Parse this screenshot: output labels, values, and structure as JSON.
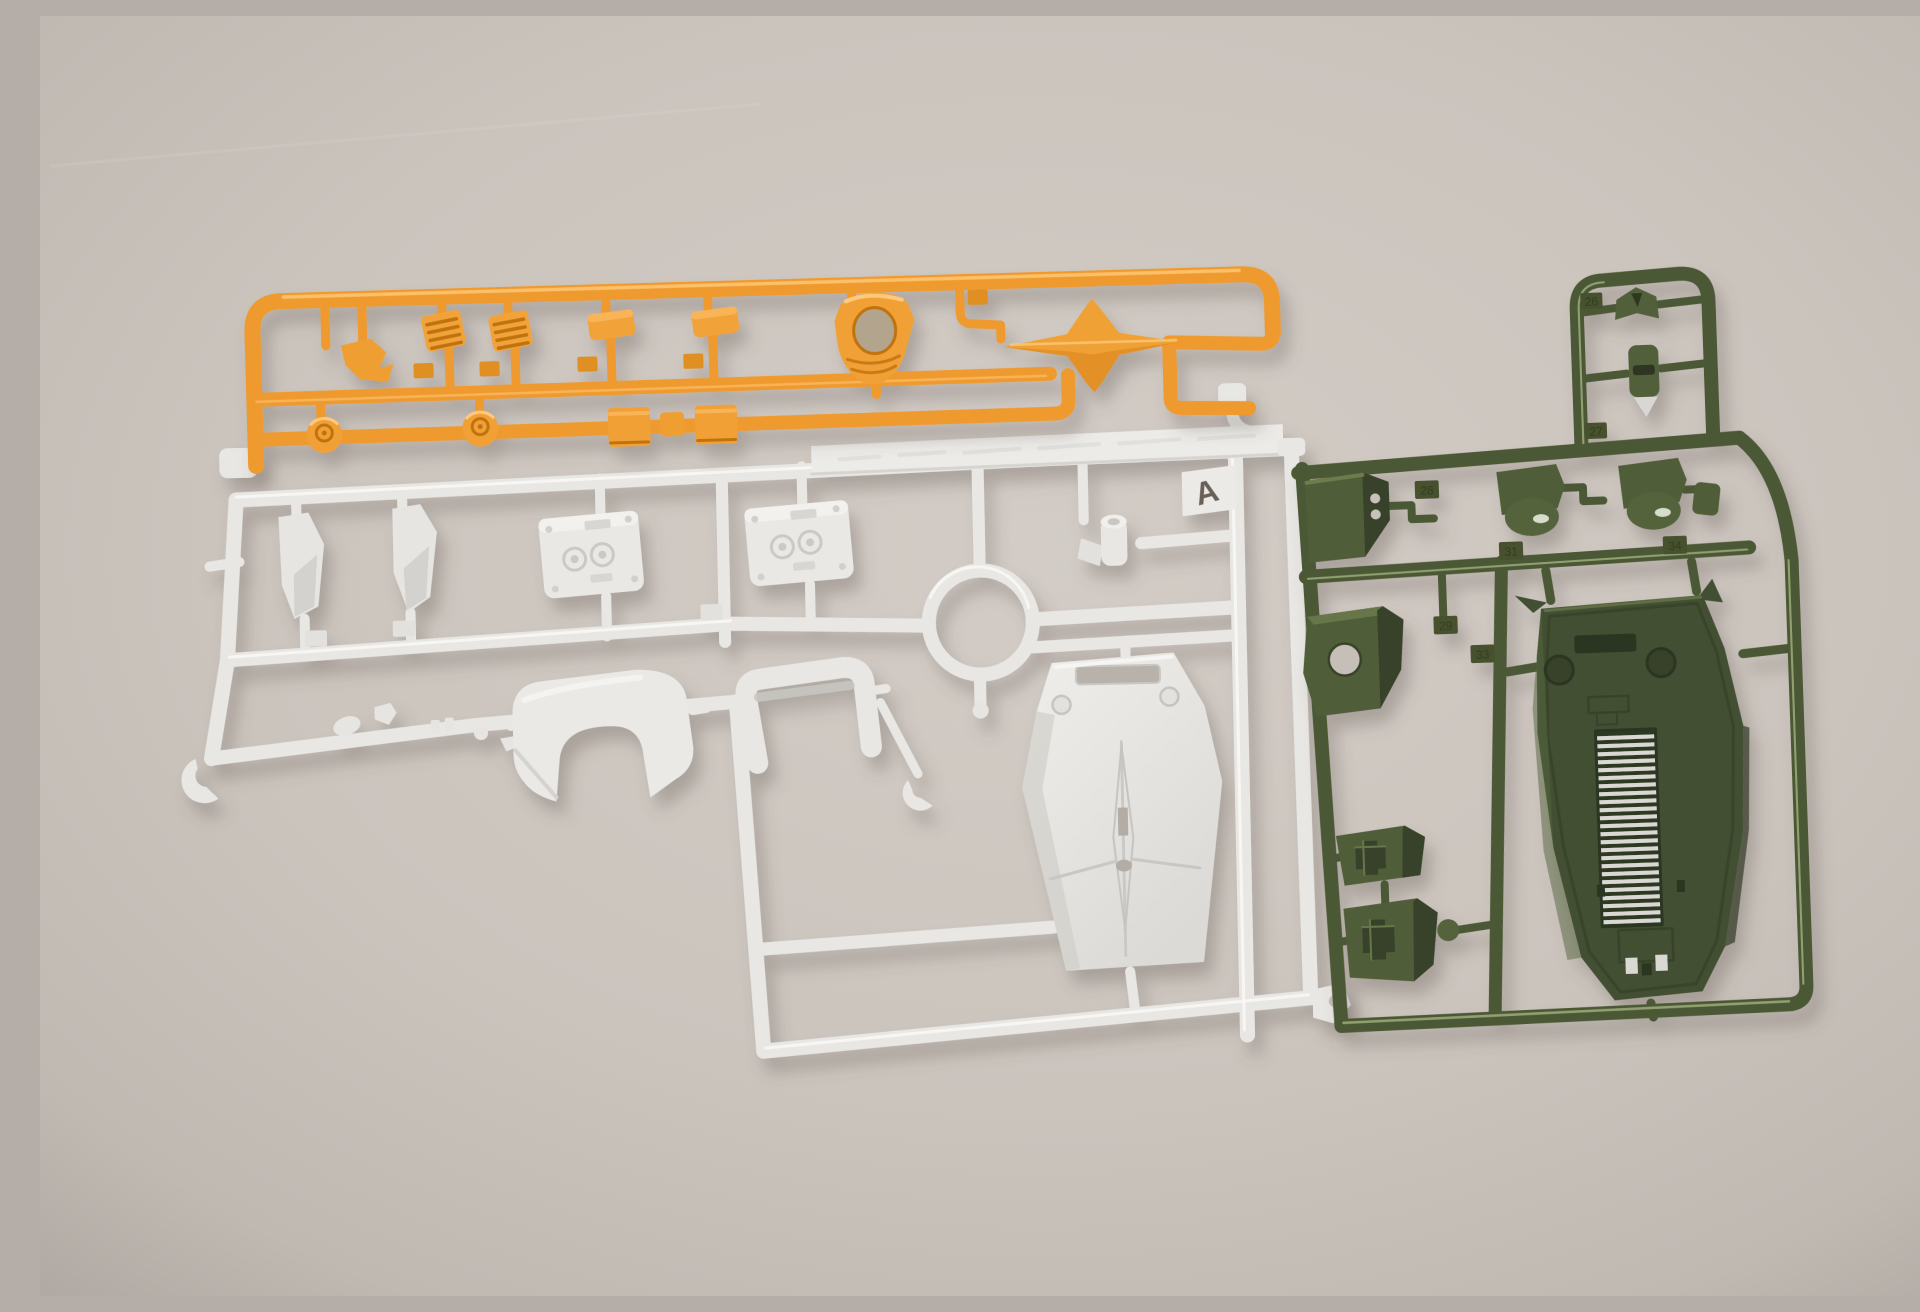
{
  "scene": {
    "type": "photograph",
    "description": "Top-down photo of three injection-molded plastic model-kit runners (sprues) lying on a plain warm-gray surface: a small orange parts runner at top left, a large light-gray runner marked A in the center, and an olive-green runner on the right.",
    "background_color": "#cbc5bf"
  },
  "orange_sprue": {
    "name": "orange parts runner",
    "color": "#ee9a2e",
    "position": "top-left",
    "parts": [
      "small clip",
      "vented hatch plate",
      "vented hatch plate",
      "flat cover pad",
      "flat cover pad",
      "round cap",
      "round cap",
      "thruster box",
      "coupler block",
      "thruster box",
      "cockpit visor with round opening",
      "four-pointed fin"
    ]
  },
  "white_sprue": {
    "name": "light-gray parts runner",
    "letter": "A",
    "color": "#e8e7e4",
    "position": "center",
    "embossed_band_note": "molded lettering on wide top bar (illegible)",
    "parts": [
      "curved fin blade",
      "curved fin blade",
      "riveted vent panel",
      "riveted vent panel",
      "pivot cylinder",
      "runner ring",
      "manipulator hand parts",
      "waist armor block",
      "waist armor frame",
      "C-clip",
      "C-clip",
      "long shield with sight slot and cross emblem"
    ]
  },
  "green_sprue": {
    "name": "olive-green parts runner",
    "color": "#4c5836",
    "position": "right",
    "molded_numbers": [
      "26",
      "27",
      "28",
      "29",
      "31",
      "33",
      "34"
    ],
    "parts": [
      "crest vane",
      "small head",
      "vent block with twin ports",
      "dome joint cover",
      "dome joint cover",
      "small coupler",
      "equipment box with port hole",
      "ammo pouch",
      "ammo pouch",
      "ball peg",
      "hull base plate with ladder ribs"
    ]
  }
}
